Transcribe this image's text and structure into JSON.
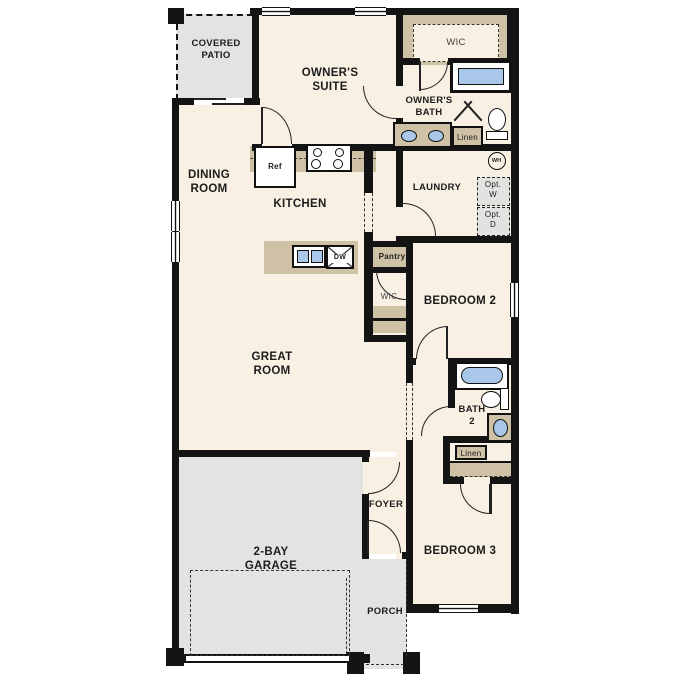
{
  "floorplan": {
    "rooms": {
      "covered_patio": "COVERED\nPATIO",
      "owners_suite": "OWNER'S\nSUITE",
      "owners_wic": "WIC",
      "owners_bath": "OWNER'S\nBATH",
      "dining_room": "DINING\nROOM",
      "kitchen": "KITCHEN",
      "laundry": "LAUNDRY",
      "bedroom2": "BEDROOM 2",
      "wic2": "WIC",
      "great_room": "GREAT\nROOM",
      "bath2": "BATH\n2",
      "bedroom3": "BEDROOM 3",
      "foyer": "FOYER",
      "garage": "2-BAY\nGARAGE",
      "porch": "PORCH"
    },
    "fixtures": {
      "ref": "Ref",
      "dw": "DW",
      "pantry": "Pantry",
      "linen_owner": "Linen",
      "linen_hall": "Linen",
      "wh": "WH",
      "opt_w": "Opt.\nW",
      "opt_d": "Opt.\nD"
    },
    "colors": {
      "room_fill": "#f7f0e3",
      "outdoor_fill": "#e4e3e1",
      "casework_fill": "#cfc1a5",
      "fixture_blue": "#a9c8e9",
      "wall": "#141414"
    }
  }
}
